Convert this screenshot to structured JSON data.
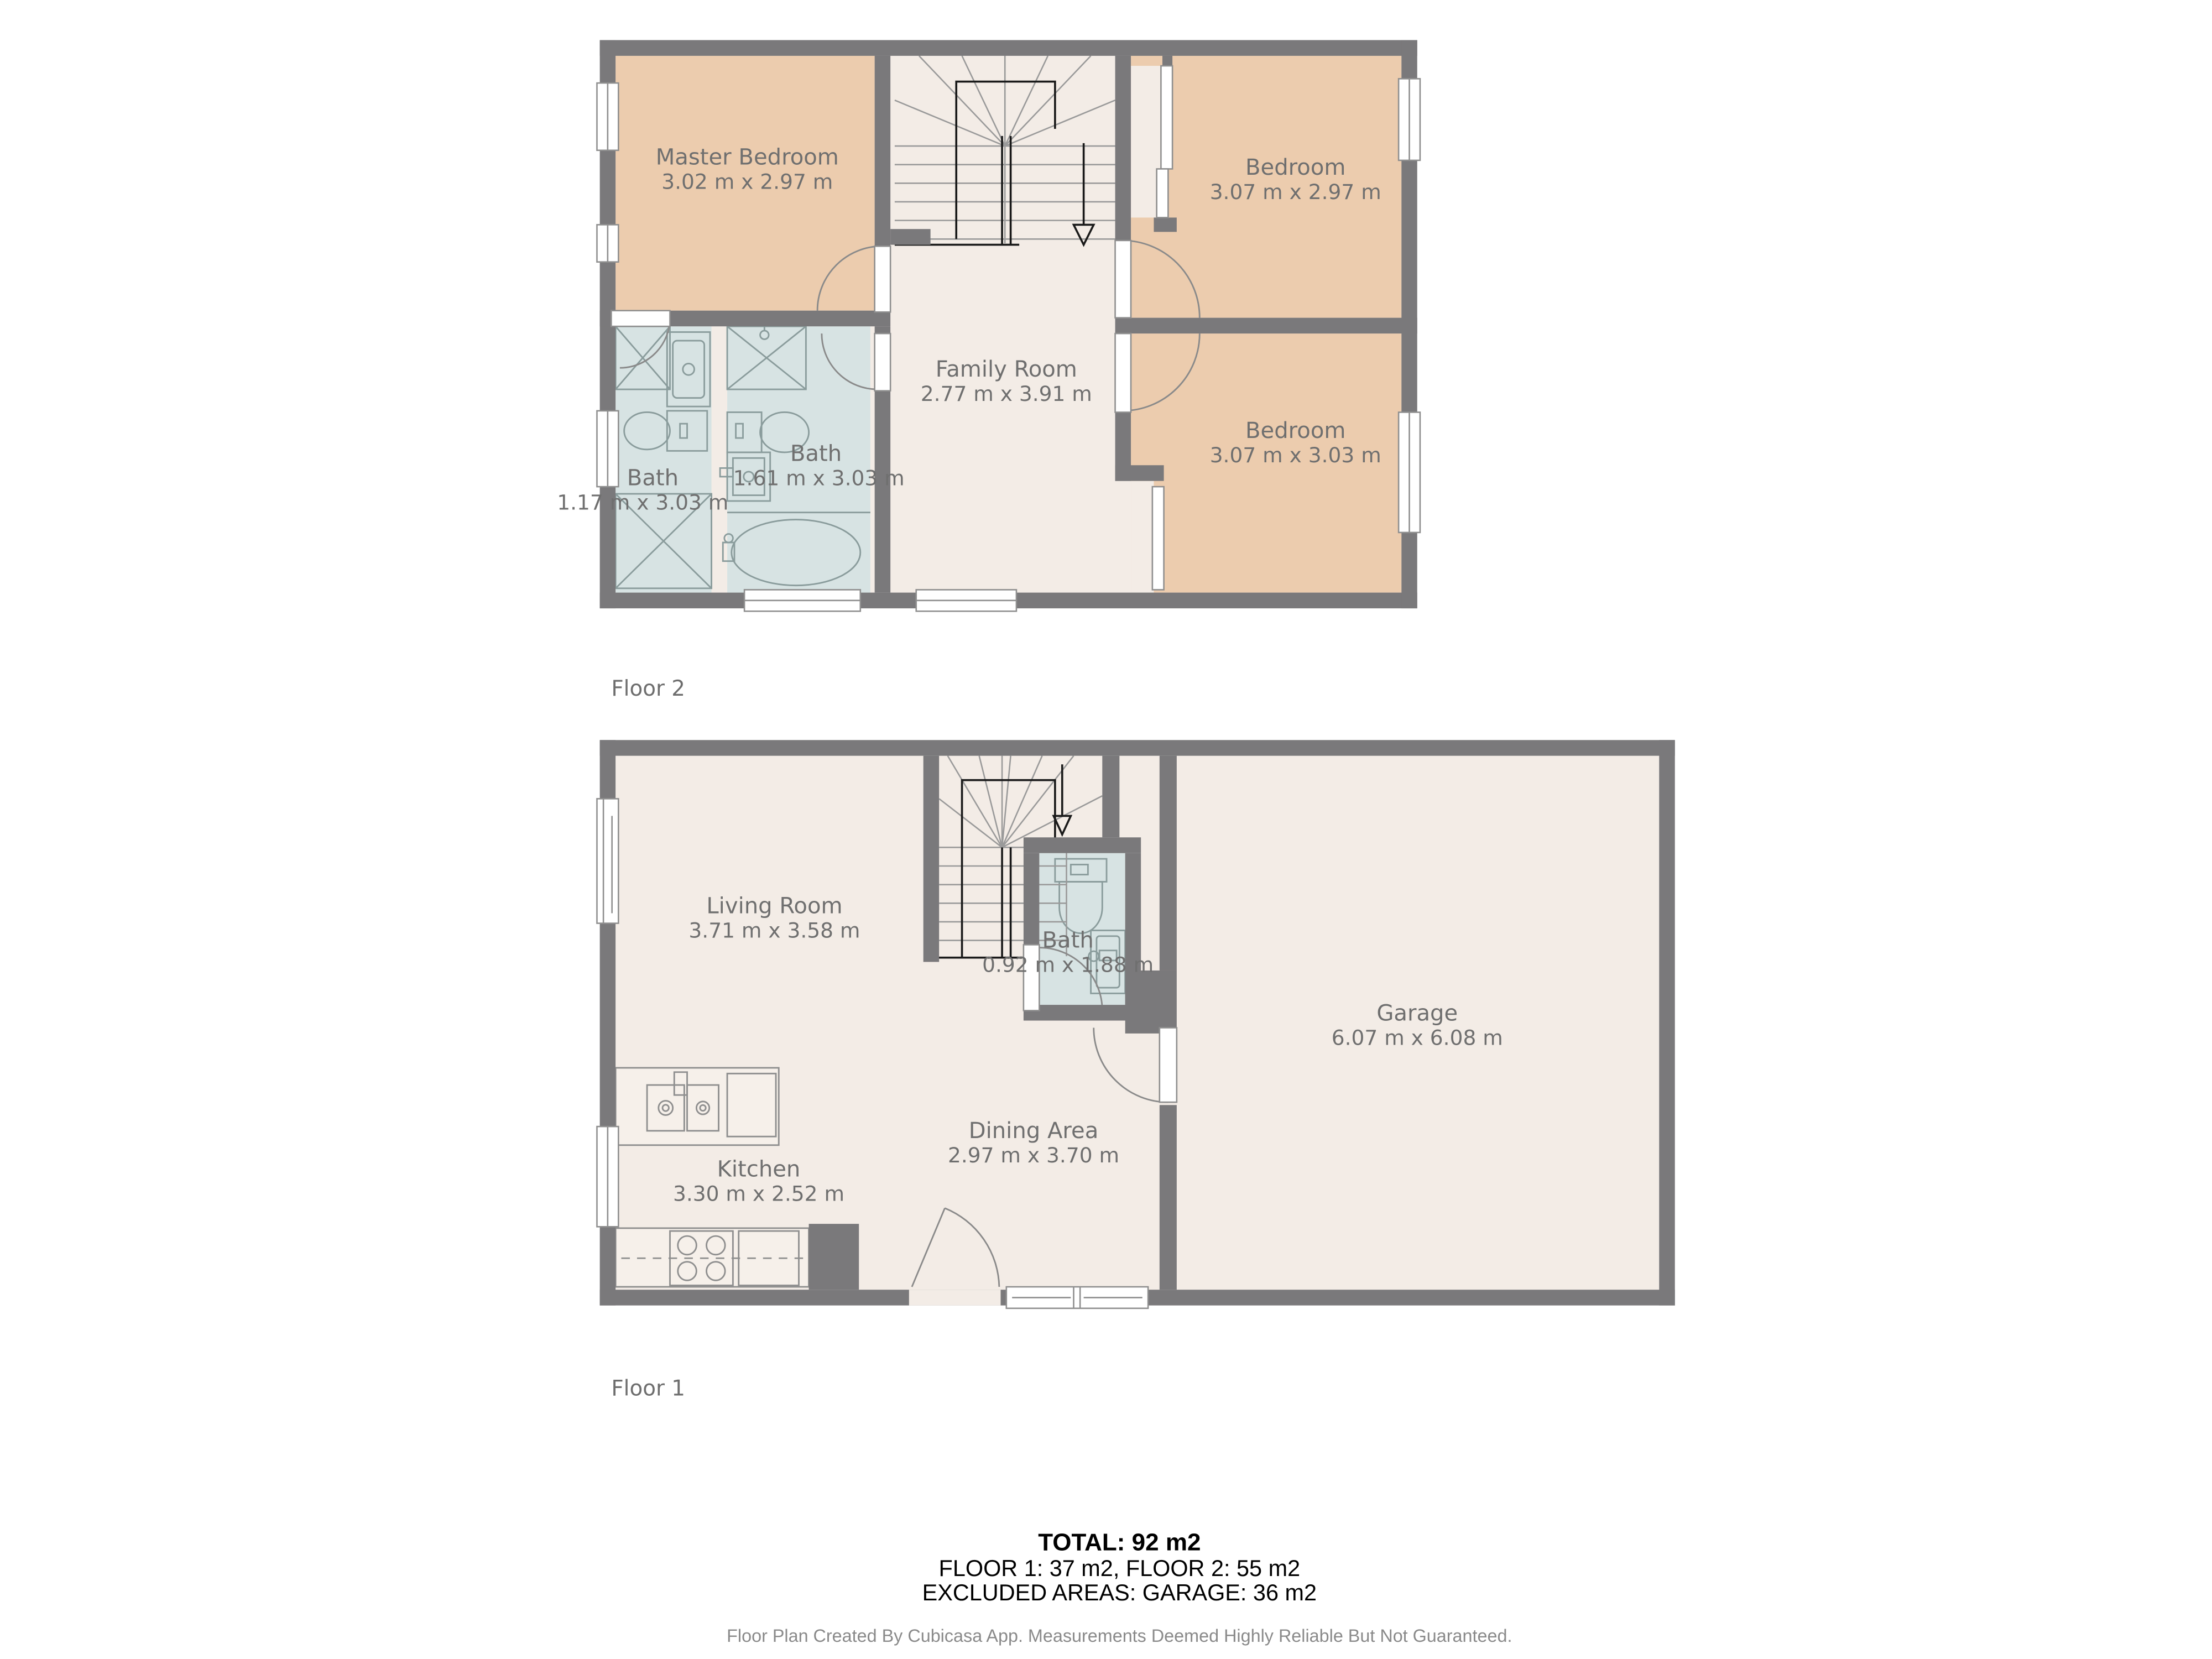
{
  "floor2": {
    "label": "Floor 2",
    "rooms": {
      "master": {
        "name": "Master Bedroom",
        "dims": "3.02 m x 2.97 m"
      },
      "bedroom_tr": {
        "name": "Bedroom",
        "dims": "3.07 m x 2.97 m"
      },
      "family": {
        "name": "Family Room",
        "dims": "2.77 m x 3.91 m"
      },
      "bath_left": {
        "name": "Bath",
        "dims": "1.17 m x 3.03 m"
      },
      "bath_mid": {
        "name": "Bath",
        "dims": "1.61 m x 3.03 m"
      },
      "bedroom_br": {
        "name": "Bedroom",
        "dims": "3.07 m x 3.03 m"
      }
    }
  },
  "floor1": {
    "label": "Floor 1",
    "rooms": {
      "living": {
        "name": "Living Room",
        "dims": "3.71 m x 3.58 m"
      },
      "bath": {
        "name": "Bath",
        "dims": "0.92 m x 1.88 m"
      },
      "garage": {
        "name": "Garage",
        "dims": "6.07 m x 6.08 m"
      },
      "dining": {
        "name": "Dining Area",
        "dims": "2.97 m x 3.70 m"
      },
      "kitchen": {
        "name": "Kitchen",
        "dims": "3.30 m x 2.52 m"
      }
    }
  },
  "summary": {
    "total": "TOTAL: 92 m2",
    "floors": "FLOOR 1: 37 m2, FLOOR 2: 55 m2",
    "excluded": "EXCLUDED AREAS: GARAGE: 36 m2"
  },
  "footer": "Floor Plan Created By Cubicasa App. Measurements Deemed Highly Reliable But Not Guaranteed.",
  "colors": {
    "wall": "#7a797b",
    "floor": "#f3ece6",
    "bedroom": "#ecccae",
    "bath": "#d7e3e3",
    "label_text": "#6f6f6f",
    "summary_text": "#000000",
    "footer_text": "#8a8a8a",
    "stair_rail": "#1a1a1a"
  }
}
